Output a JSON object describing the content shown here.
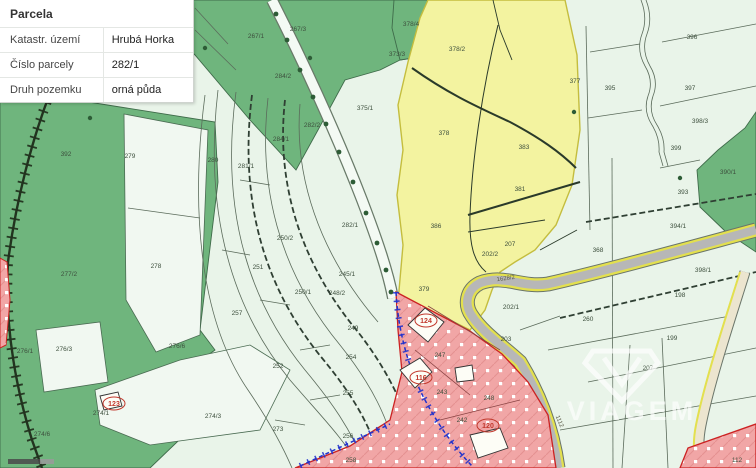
{
  "panel": {
    "title": "Parcela",
    "rows": [
      {
        "label": "Katastr. území",
        "value": "Hrubá Horka"
      },
      {
        "label": "Číslo parcely",
        "value": "282/1"
      },
      {
        "label": "Druh pozemku",
        "value": "orná půda"
      }
    ]
  },
  "watermark": {
    "text": "VIAGEM"
  },
  "colors": {
    "highlight_yellow": "#f3f3a0",
    "forest_green": "#6fb57d",
    "light_parcel": "#f1f8f1",
    "urban_red": "#f1a6a6",
    "road_gray": "#b7b7b7",
    "road_edge_yellow": "#e3e04e",
    "easement_blue": "#2233cc"
  },
  "map": {
    "labels": [
      {
        "text": "392",
        "x": 66,
        "y": 156,
        "kind": "parcel"
      },
      {
        "text": "279",
        "x": 130,
        "y": 158,
        "kind": "parcel"
      },
      {
        "text": "278",
        "x": 156,
        "y": 268,
        "kind": "parcel"
      },
      {
        "text": "277/2",
        "x": 69,
        "y": 276,
        "kind": "parcel"
      },
      {
        "text": "276/1",
        "x": 25,
        "y": 353,
        "kind": "parcel"
      },
      {
        "text": "276/3",
        "x": 64,
        "y": 351,
        "kind": "parcel"
      },
      {
        "text": "276/6",
        "x": 177,
        "y": 348,
        "kind": "parcel"
      },
      {
        "text": "274/1",
        "x": 101,
        "y": 415,
        "kind": "parcel"
      },
      {
        "text": "274/6",
        "x": 42,
        "y": 436,
        "kind": "parcel"
      },
      {
        "text": "123",
        "x": 114,
        "y": 406,
        "kind": "house"
      },
      {
        "text": "267/1",
        "x": 256,
        "y": 38,
        "kind": "parcel"
      },
      {
        "text": "267/3",
        "x": 298,
        "y": 31,
        "kind": "parcel"
      },
      {
        "text": "284/2",
        "x": 283,
        "y": 78,
        "kind": "parcel"
      },
      {
        "text": "373/3",
        "x": 397,
        "y": 56,
        "kind": "parcel"
      },
      {
        "text": "378/4",
        "x": 411,
        "y": 26,
        "kind": "parcel"
      },
      {
        "text": "280",
        "x": 213,
        "y": 162,
        "kind": "parcel"
      },
      {
        "text": "281/1",
        "x": 246,
        "y": 168,
        "kind": "parcel"
      },
      {
        "text": "284/1",
        "x": 281,
        "y": 141,
        "kind": "parcel"
      },
      {
        "text": "282/2",
        "x": 312,
        "y": 127,
        "kind": "parcel"
      },
      {
        "text": "375/1",
        "x": 365,
        "y": 110,
        "kind": "parcel"
      },
      {
        "text": "282/1",
        "x": 350,
        "y": 227,
        "kind": "parcel"
      },
      {
        "text": "250/2",
        "x": 285,
        "y": 240,
        "kind": "parcel"
      },
      {
        "text": "251",
        "x": 258,
        "y": 269,
        "kind": "parcel"
      },
      {
        "text": "245/1",
        "x": 347,
        "y": 276,
        "kind": "parcel"
      },
      {
        "text": "250/1",
        "x": 303,
        "y": 294,
        "kind": "parcel"
      },
      {
        "text": "248/2",
        "x": 337,
        "y": 295,
        "kind": "parcel"
      },
      {
        "text": "257",
        "x": 237,
        "y": 315,
        "kind": "parcel"
      },
      {
        "text": "249",
        "x": 353,
        "y": 330,
        "kind": "parcel"
      },
      {
        "text": "252",
        "x": 278,
        "y": 368,
        "kind": "parcel"
      },
      {
        "text": "254",
        "x": 351,
        "y": 359,
        "kind": "parcel"
      },
      {
        "text": "255",
        "x": 348,
        "y": 395,
        "kind": "parcel"
      },
      {
        "text": "274/3",
        "x": 213,
        "y": 418,
        "kind": "parcel"
      },
      {
        "text": "273",
        "x": 278,
        "y": 431,
        "kind": "parcel"
      },
      {
        "text": "256",
        "x": 348,
        "y": 438,
        "kind": "parcel"
      },
      {
        "text": "258",
        "x": 351,
        "y": 462,
        "kind": "parcel"
      },
      {
        "text": "378/2",
        "x": 457,
        "y": 51,
        "kind": "parcel"
      },
      {
        "text": "377",
        "x": 575,
        "y": 83,
        "kind": "parcel"
      },
      {
        "text": "378",
        "x": 444,
        "y": 135,
        "kind": "parcel"
      },
      {
        "text": "383",
        "x": 524,
        "y": 149,
        "kind": "parcel"
      },
      {
        "text": "381",
        "x": 520,
        "y": 191,
        "kind": "parcel"
      },
      {
        "text": "386",
        "x": 436,
        "y": 228,
        "kind": "parcel"
      },
      {
        "text": "207",
        "x": 510,
        "y": 246,
        "kind": "parcel"
      },
      {
        "text": "202/2",
        "x": 490,
        "y": 256,
        "kind": "parcel"
      },
      {
        "text": "379",
        "x": 424,
        "y": 291,
        "kind": "parcel"
      },
      {
        "text": "396",
        "x": 692,
        "y": 39,
        "kind": "parcel"
      },
      {
        "text": "395",
        "x": 610,
        "y": 90,
        "kind": "parcel"
      },
      {
        "text": "397",
        "x": 690,
        "y": 90,
        "kind": "parcel"
      },
      {
        "text": "398/3",
        "x": 700,
        "y": 123,
        "kind": "parcel"
      },
      {
        "text": "399",
        "x": 676,
        "y": 150,
        "kind": "parcel"
      },
      {
        "text": "390/1",
        "x": 728,
        "y": 174,
        "kind": "parcel"
      },
      {
        "text": "393",
        "x": 683,
        "y": 194,
        "kind": "parcel"
      },
      {
        "text": "394/1",
        "x": 678,
        "y": 228,
        "kind": "parcel"
      },
      {
        "text": "368",
        "x": 598,
        "y": 252,
        "kind": "parcel"
      },
      {
        "text": "398/1",
        "x": 703,
        "y": 272,
        "kind": "parcel"
      },
      {
        "text": "198",
        "x": 680,
        "y": 297,
        "kind": "parcel"
      },
      {
        "text": "260",
        "x": 588,
        "y": 321,
        "kind": "parcel"
      },
      {
        "text": "202/1",
        "x": 511,
        "y": 309,
        "kind": "parcel"
      },
      {
        "text": "203",
        "x": 506,
        "y": 341,
        "kind": "parcel"
      },
      {
        "text": "199",
        "x": 672,
        "y": 340,
        "kind": "parcel"
      },
      {
        "text": "207",
        "x": 648,
        "y": 370,
        "kind": "parcel"
      },
      {
        "text": "112",
        "x": 737,
        "y": 462,
        "kind": "parcel"
      },
      {
        "text": "1628/2",
        "x": 506,
        "y": 280,
        "kind": "road",
        "rot": -8
      },
      {
        "text": "1112",
        "x": 558,
        "y": 422,
        "kind": "road",
        "rot": 68
      },
      {
        "text": "124",
        "x": 426,
        "y": 323,
        "kind": "house"
      },
      {
        "text": "247",
        "x": 440,
        "y": 357,
        "kind": "parcel"
      },
      {
        "text": "116",
        "x": 421,
        "y": 380,
        "kind": "house"
      },
      {
        "text": "243",
        "x": 442,
        "y": 394,
        "kind": "parcel"
      },
      {
        "text": "248",
        "x": 489,
        "y": 400,
        "kind": "parcel"
      },
      {
        "text": "242",
        "x": 462,
        "y": 422,
        "kind": "parcel"
      },
      {
        "text": "120",
        "x": 488,
        "y": 428,
        "kind": "house"
      }
    ]
  }
}
